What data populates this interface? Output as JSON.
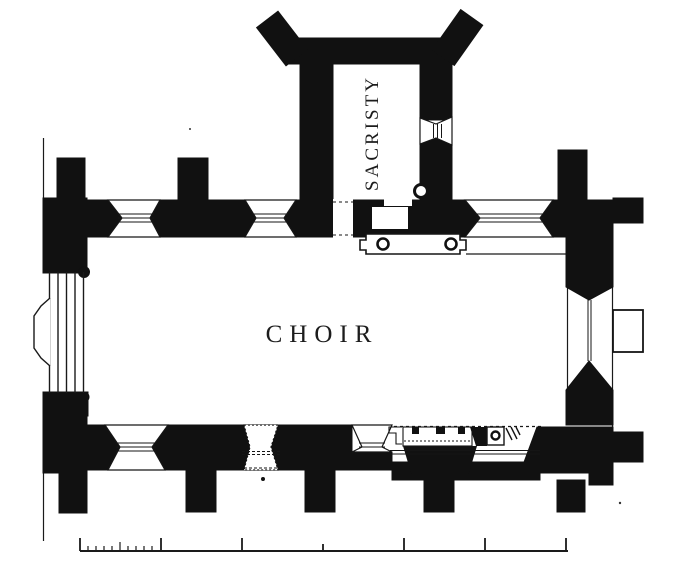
{
  "labels": {
    "choir": "CHOIR",
    "sacristy": "SACRISTY"
  },
  "colors": {
    "ink": "#111111",
    "paper": "#ffffff"
  },
  "scale_bar": {
    "major_divisions": 6,
    "first_division_subdivisions": 10
  }
}
